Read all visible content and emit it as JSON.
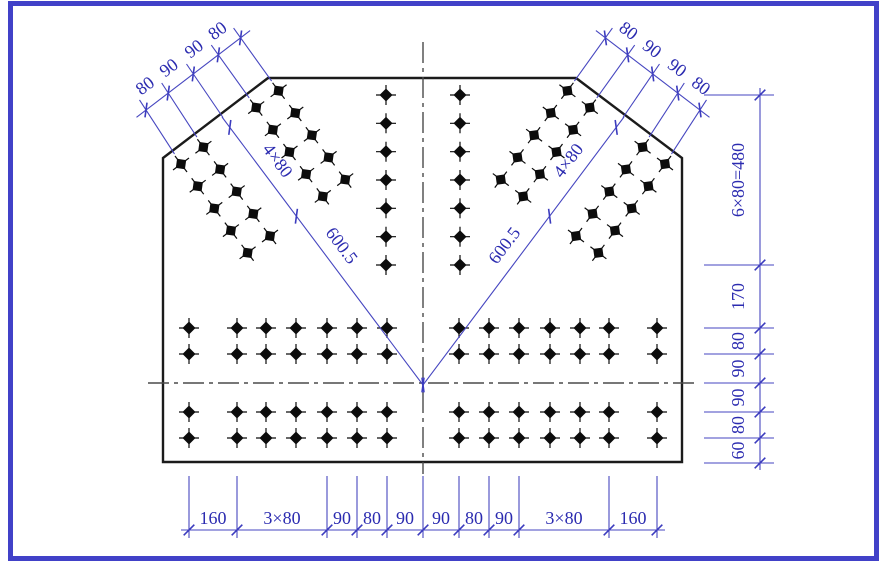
{
  "drawing": {
    "kind": "structural gusset plate bolt layout drawing",
    "colors": {
      "frame": "#4141c8",
      "dimension_lines": "#4646c0",
      "dimension_text": "#2b2bb0",
      "plate_outline": "#1b1b1b",
      "bolts": "#0c0c0c",
      "centerlines": "#4a4a4a",
      "background": "#ffffff"
    },
    "dimension_labels": {
      "top_left_chain": [
        "80",
        "90",
        "90",
        "80"
      ],
      "top_right_chain": [
        "80",
        "90",
        "90",
        "80"
      ],
      "left_brace_pitch": "4×80",
      "left_brace_distance": "600.5",
      "right_brace_pitch": "4×80",
      "right_brace_distance": "600.5",
      "right_chain": [
        "6×80=480",
        "170",
        "80",
        "90",
        "90",
        "80",
        "60"
      ],
      "bottom_chain": [
        "160",
        "3×80",
        "90",
        "80",
        "90",
        "90",
        "80",
        "90",
        "3×80",
        "160"
      ]
    },
    "bolt_pattern": {
      "diagonal_groups": 2,
      "diagonal_group_rows": 5,
      "diagonal_group_gauge_lines": 4,
      "vertical_columns": 2,
      "bolts_per_vertical_column": 7,
      "horizontal_band_rows": 4,
      "bolts_per_horizontal_row": 14,
      "total_bolts": 110
    }
  }
}
